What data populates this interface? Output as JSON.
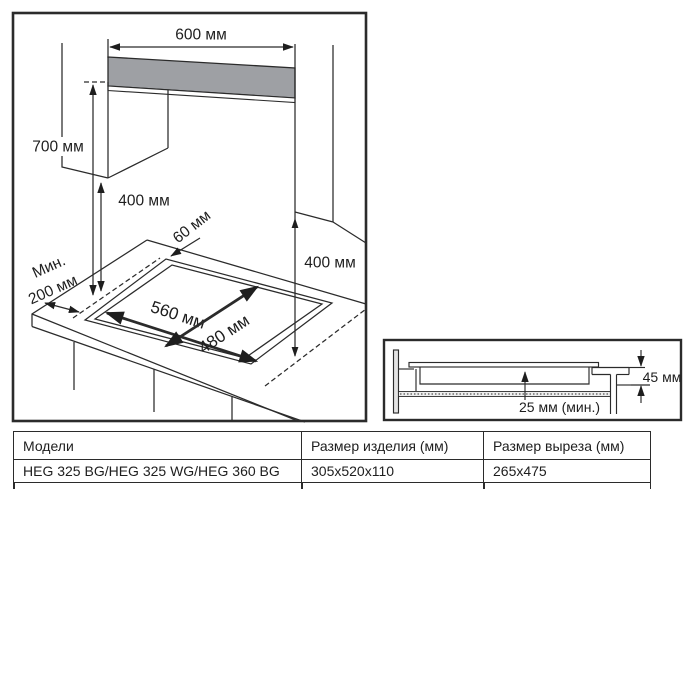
{
  "diagram": {
    "top_width": "600 мм",
    "hood_height": "700 мм",
    "cabinet_height_left": "400 мм",
    "rear_gap": "60 мм",
    "side_min_1": "Мин.",
    "side_min_2": "200 мм",
    "cutout_width": "560 мм",
    "cutout_depth": "480 мм",
    "cabinet_height_right": "400 мм"
  },
  "section": {
    "embed_depth": "45 мм",
    "bottom_clearance": "25 мм (мин.)"
  },
  "table": {
    "headers": [
      "Модели",
      "Размер изделия (мм)",
      "Размер выреза (мм)"
    ],
    "rows": [
      [
        "HEG 325 BG/HEG 325 WG/HEG 360 BG",
        "305x520x110",
        "265x475"
      ]
    ]
  },
  "colors": {
    "hood_fill": "#9ea0a4",
    "line": "#2b2b2b"
  }
}
